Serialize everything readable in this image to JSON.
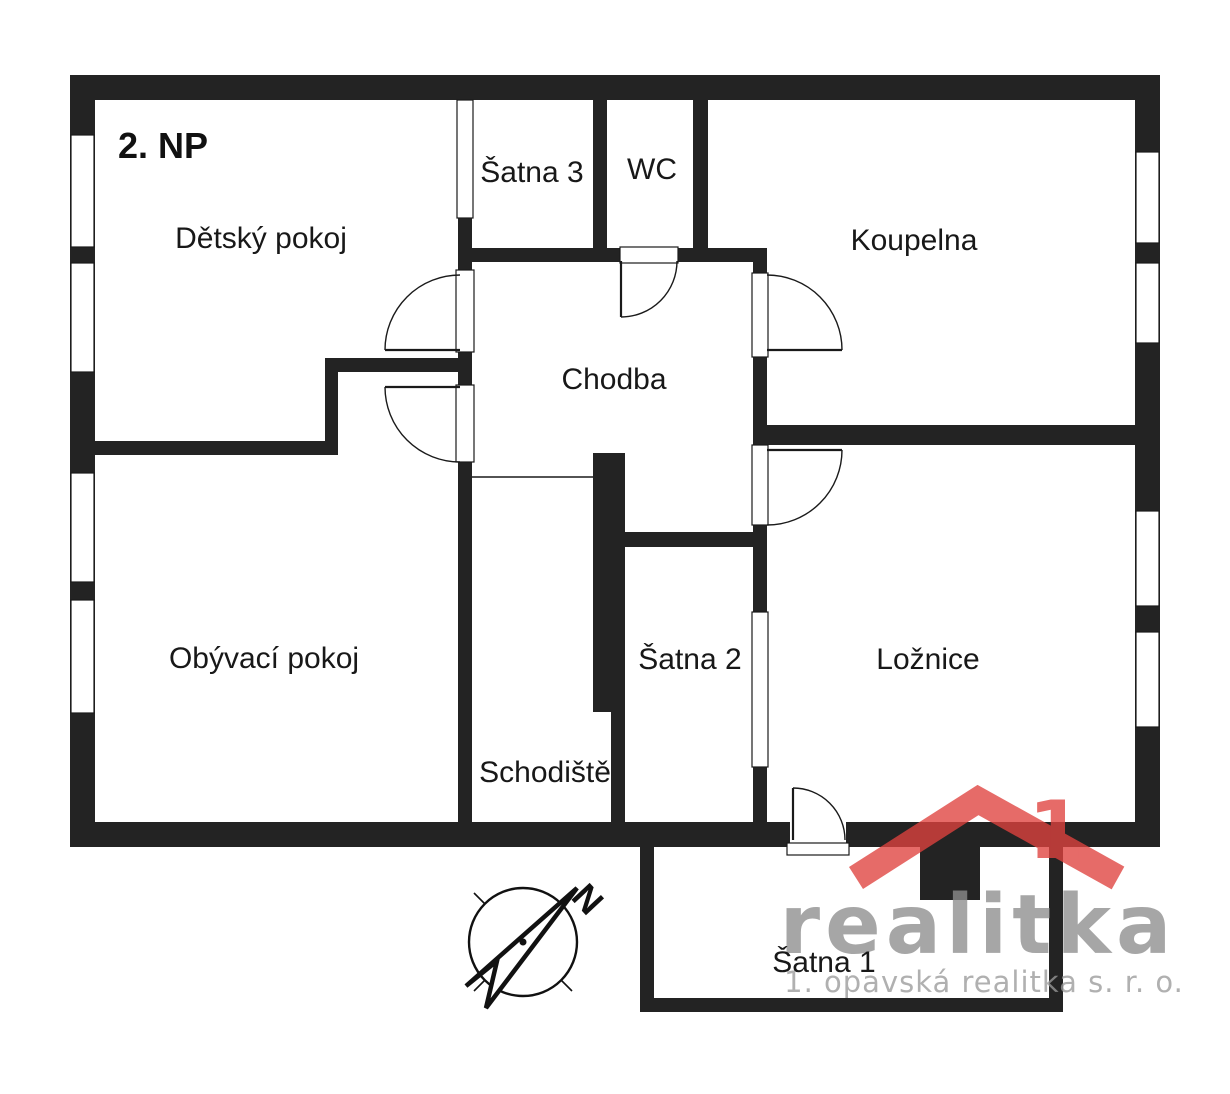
{
  "floor_plan": {
    "floor_label": "2. NP",
    "rooms": {
      "detsky_pokoj": "Dětský pokoj",
      "satna3": "Šatna 3",
      "wc": "WC",
      "koupelna": "Koupelna",
      "chodba": "Chodba",
      "obyvaci_pokoj": "Obývací pokoj",
      "schodiste": "Schodiště",
      "satna2": "Šatna 2",
      "loznice": "Ložnice",
      "satna1": "Šatna 1"
    },
    "colors": {
      "wall": "#232323",
      "background": "#ffffff",
      "watermark_red": "#e0423e",
      "watermark_gray": "#8e8e8e"
    }
  },
  "compass": {
    "north_label": "N"
  },
  "watermark": {
    "brand": "realitka",
    "logo_numeral": "1",
    "company": "1. opavská realitka s. r. o."
  }
}
